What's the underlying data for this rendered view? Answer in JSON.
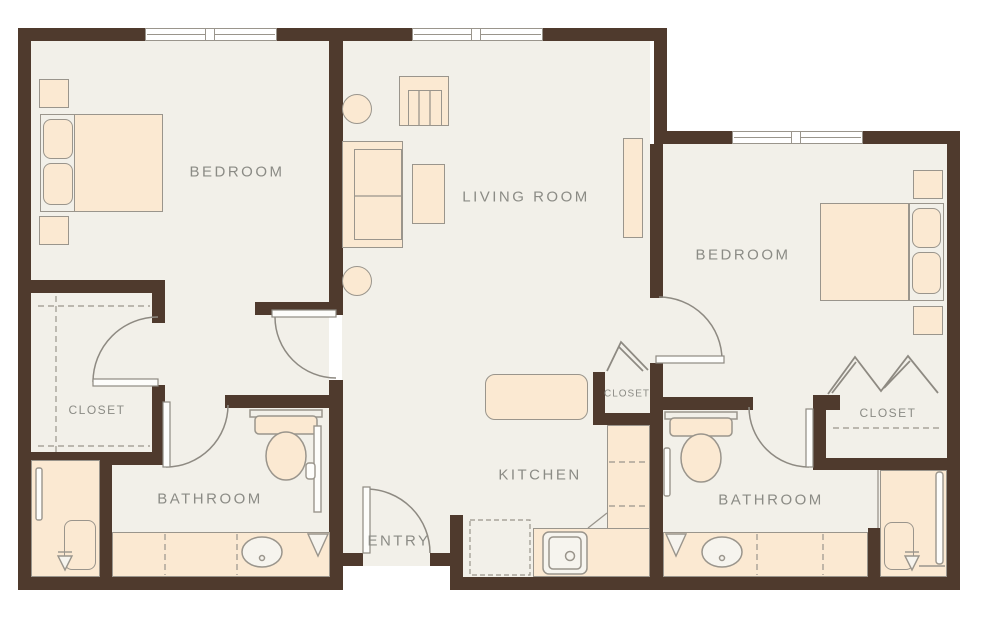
{
  "title": "Two Bedroom Two Bath Floor Plan",
  "colors": {
    "wall": "#4f3a2d",
    "floor": "#f2f0e9",
    "furniture": "#fbe9d2",
    "outline": "#9a958c",
    "label": "#8b8b85",
    "window": "#ffffff"
  },
  "rooms": {
    "bedroom_left": "BEDROOM",
    "living_room": "LIVING ROOM",
    "bedroom_right": "BEDROOM",
    "closet_left": "CLOSET",
    "closet_center": "CLOSET",
    "closet_right": "CLOSET",
    "bathroom_left": "BATHROOM",
    "bathroom_right": "BATHROOM",
    "kitchen": "KITCHEN",
    "entry": "ENTRY"
  }
}
